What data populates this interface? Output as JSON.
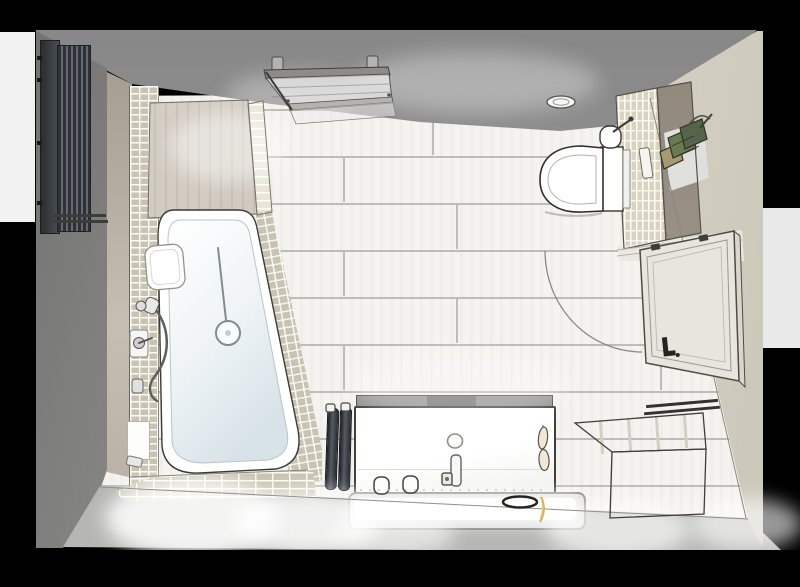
{
  "meta": {
    "type": "3d-architectural-rendering",
    "subject": "Bathroom floor plan, top-down perspective rendering with spotlights",
    "visible_text": ""
  },
  "colors": {
    "backdrop": "#000000",
    "bgPanelLeft": "#f2f2f2",
    "bgPanelRight": "#e9e9e9",
    "ceiling": "#8f8f8f",
    "wallLeft": "#a2a2a0",
    "wallBottom": "#a4a4a2",
    "wallRight": "#e3dfd1",
    "wallRightDark": "#c9c5b8",
    "floor": "#f4f3f0",
    "grout": "#bcbcb9",
    "woodWall": "#c6beb2",
    "deck": "#d8d2c9",
    "mosaic": "#c9c4b1",
    "mosaicLight": "#e9e6d8",
    "partitionMosaic": "#dad4be",
    "partitionWood": "#a89e92",
    "radiatorDark": "#2e3237",
    "radiatorLight": "#646a71",
    "fixtureWhite": "#ffffff",
    "tubShade": "#dfe8ec",
    "outline": "#3b3a37",
    "doorFill": "#e7e5dd",
    "doorEdge": "#d8d6cd",
    "threshold": "#eae8e0",
    "oak": "#ead9bc",
    "benchTop": "#5a554e",
    "benchDivider": "#d4cec4",
    "towelDark": "#1e2125",
    "towelLight": "#555b61",
    "plantGreen": "#6a794f",
    "plantDarkGreen": "#55644a",
    "plantTan": "#a59a72",
    "panelWhite": "#f2f2f0",
    "gold": "#d9b35a",
    "glow": "#ffffff"
  },
  "items": {
    "scene": "Bathroom 3D floor plan (top view)",
    "floor": "Wood-look tile floor",
    "ceiling": "Ceiling shadow band",
    "leftWall": "Left wall",
    "bottomWall": "Bottom wall",
    "rightWall": "Right wall",
    "radiator": "Vertical designer radiator",
    "bathtub": "Bathtub",
    "headrest": "Bath pillow",
    "mosaicStrip": "Mosaic tile tub surround",
    "deck": "Wood-clad shower wall",
    "screen": "Ceiling-mounted glass shower screen",
    "fittings": "Shower fittings",
    "niche": "Shower wall niche",
    "toilet": "Wall-hung toilet",
    "brush": "Toilet brush",
    "flushPlate": "Flush plate",
    "partition": "Tiled partition wall",
    "spotlight": "Ceiling spotlight",
    "plant": "Wall plant holder",
    "door": "Room door (open)",
    "swing": "Door swing arc",
    "threshold": "Doorway threshold",
    "vanity": "Washbasin unit",
    "drain": "Basin drain",
    "faucet": "Basin faucet",
    "cups": "Bathroom cups",
    "decorLeaves": "Leaf decoration",
    "mat": "Bath mat",
    "towels": "Hanging towels",
    "bench": "Wooden storage bench",
    "pools": "Floor light pools"
  }
}
